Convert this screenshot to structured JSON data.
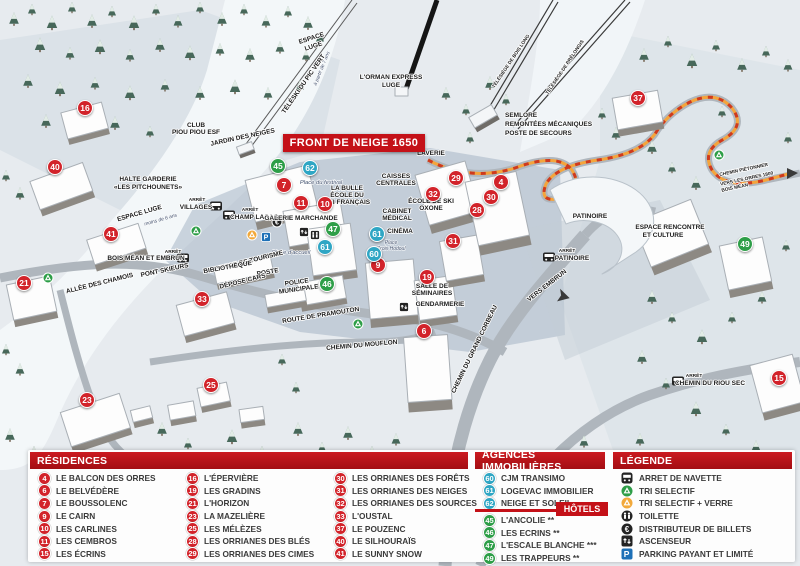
{
  "map": {
    "front_badge": "FRONT DE NEIGE 1650",
    "labels": [
      {
        "t": "ESPACE"
      },
      {
        "t": "LUGE"
      },
      {
        "t": "à partir de 7 ans"
      },
      {
        "t": "TÉLÉSKI DU PIC VERT"
      },
      {
        "t": "L'ORMAN EXPRESS"
      },
      {
        "t": "LUGE"
      },
      {
        "t": "TÉLÉSIÈGE DE BOIS LONG"
      },
      {
        "t": "TÉLÉSIÈGE DE PRÉLONGIS"
      },
      {
        "t": "SEMLORE"
      },
      {
        "t": "REMONTÉES MÉCANIQUES"
      },
      {
        "t": "POSTE DE SECOURS"
      },
      {
        "t": "LAVERIE"
      },
      {
        "t": "CLUB"
      },
      {
        "t": "PIOU PIOU ESF"
      },
      {
        "t": "JARDIN DES NEIGES"
      },
      {
        "t": "HALTE GARDERIE"
      },
      {
        "t": "«LES PITCHOUNETS»"
      },
      {
        "t": "ESPACE LUGE"
      },
      {
        "t": "moins de 6 ans"
      },
      {
        "t": "ARRÊT"
      },
      {
        "t": "VILLAGES"
      },
      {
        "t": "ARRÊT"
      },
      {
        "t": "CHAMP LACAS"
      },
      {
        "t": "GALERIE MARCHANDE"
      },
      {
        "t": "LA BULLE"
      },
      {
        "t": "ÉCOLE DU"
      },
      {
        "t": "SKI FRANÇAIS"
      },
      {
        "t": "Place du festival"
      },
      {
        "t": "CAISSES"
      },
      {
        "t": "CENTRALES"
      },
      {
        "t": "ÉCOLE DE SKI"
      },
      {
        "t": "OXONE"
      },
      {
        "t": "CABINET"
      },
      {
        "t": "MÉDICAL"
      },
      {
        "t": "CINÉMA"
      },
      {
        "t": "Place"
      },
      {
        "t": "Croix Hodoul"
      },
      {
        "t": "Place d'accueil"
      },
      {
        "t": "OFFICE DE TOURISME"
      },
      {
        "t": "BIBLIOTHÈQUE"
      },
      {
        "t": "POSTE"
      },
      {
        "t": "DÉPOSE CARS"
      },
      {
        "t": "POLICE"
      },
      {
        "t": "MUNICIPALE"
      },
      {
        "t": "ARRÊT"
      },
      {
        "t": "BOIS MÉAN ET EMBRUN"
      },
      {
        "t": "PONT SKIEURS"
      },
      {
        "t": "ALLÉE DES CHAMOIS"
      },
      {
        "t": "ROUTE DE PRAMOUTON"
      },
      {
        "t": "CHEMIN DU MOUFLON"
      },
      {
        "t": "CHEMIN DU GRAND CORBEAU"
      },
      {
        "t": "SALLE DE"
      },
      {
        "t": "SÉMINAIRES"
      },
      {
        "t": "GENDARMERIE"
      },
      {
        "t": "ARRÊT"
      },
      {
        "t": "PATINOIRE"
      },
      {
        "t": "PATINOIRE"
      },
      {
        "t": "ESPACE RENCONTRE"
      },
      {
        "t": "ET CULTURE"
      },
      {
        "t": "VERS EMBRUN"
      },
      {
        "t": "CHEMIN PIÉTONNIER"
      },
      {
        "t": "VERS LES ORRES 1800"
      },
      {
        "t": "BOIS MÉAN"
      },
      {
        "t": "ARRÊT"
      },
      {
        "t": "CHEMIN DU RIOU SEC"
      }
    ],
    "markers_red": [
      {
        "n": "16",
        "x": 85,
        "y": 108
      },
      {
        "n": "40",
        "x": 55,
        "y": 167
      },
      {
        "n": "41",
        "x": 111,
        "y": 234
      },
      {
        "n": "21",
        "x": 24,
        "y": 283
      },
      {
        "n": "33",
        "x": 202,
        "y": 299
      },
      {
        "n": "23",
        "x": 87,
        "y": 400
      },
      {
        "n": "25",
        "x": 211,
        "y": 385
      },
      {
        "n": "7",
        "x": 284,
        "y": 185
      },
      {
        "n": "11",
        "x": 301,
        "y": 203
      },
      {
        "n": "10",
        "x": 325,
        "y": 204
      },
      {
        "n": "9",
        "x": 378,
        "y": 265
      },
      {
        "n": "29",
        "x": 456,
        "y": 178
      },
      {
        "n": "32",
        "x": 433,
        "y": 194
      },
      {
        "n": "4",
        "x": 501,
        "y": 182
      },
      {
        "n": "30",
        "x": 491,
        "y": 197
      },
      {
        "n": "28",
        "x": 477,
        "y": 210
      },
      {
        "n": "31",
        "x": 453,
        "y": 241
      },
      {
        "n": "19",
        "x": 427,
        "y": 277
      },
      {
        "n": "6",
        "x": 424,
        "y": 331
      },
      {
        "n": "37",
        "x": 638,
        "y": 98
      },
      {
        "n": "15",
        "x": 779,
        "y": 378
      }
    ],
    "markers_green": [
      {
        "n": "45",
        "x": 278,
        "y": 166
      },
      {
        "n": "47",
        "x": 333,
        "y": 229
      },
      {
        "n": "46",
        "x": 327,
        "y": 284
      },
      {
        "n": "49",
        "x": 745,
        "y": 244
      }
    ],
    "markers_blue": [
      {
        "n": "62",
        "x": 310,
        "y": 168
      },
      {
        "n": "61",
        "x": 325,
        "y": 247
      },
      {
        "n": "61",
        "x": 377,
        "y": 234
      },
      {
        "n": "60",
        "x": 374,
        "y": 254
      }
    ]
  },
  "panel": {
    "residences": {
      "title": "RÉSIDENCES",
      "col1": [
        {
          "num": "4",
          "name": "LE BALCON DES ORRES"
        },
        {
          "num": "6",
          "name": "LE BELVÉDÈRE"
        },
        {
          "num": "7",
          "name": "LE BOUSSOLENC"
        },
        {
          "num": "9",
          "name": "LE CAIRN"
        },
        {
          "num": "10",
          "name": "LES CARLINES"
        },
        {
          "num": "11",
          "name": "LES CEMBROS"
        },
        {
          "num": "15",
          "name": "LES ÉCRINS"
        }
      ],
      "col2": [
        {
          "num": "16",
          "name": "L'ÉPERVIÈRE"
        },
        {
          "num": "19",
          "name": "LES GRADINS"
        },
        {
          "num": "21",
          "name": "L'HORIZON"
        },
        {
          "num": "23",
          "name": "LA MAZELIÈRE"
        },
        {
          "num": "25",
          "name": "LES MÉLÈZES"
        },
        {
          "num": "28",
          "name": "LES ORRIANES DES BLÉS"
        },
        {
          "num": "29",
          "name": "LES ORRIANES DES CIMES"
        }
      ],
      "col3": [
        {
          "num": "30",
          "name": "LES ORRIANES DES FORÊTS"
        },
        {
          "num": "31",
          "name": "LES ORRIANES DES NEIGES"
        },
        {
          "num": "32",
          "name": "LES ORRIANES DES SOURCES"
        },
        {
          "num": "33",
          "name": "L'OUSTAL"
        },
        {
          "num": "37",
          "name": "LE POUZENC"
        },
        {
          "num": "40",
          "name": "LE SILHOURAÏS"
        },
        {
          "num": "41",
          "name": "LE SUNNY SNOW"
        }
      ]
    },
    "agences": {
      "title": "AGENCES IMMOBILIÈRES",
      "items": [
        {
          "num": "60",
          "name": "CJM TRANSIMO"
        },
        {
          "num": "61",
          "name": "LOGEVAC IMMOBILIER"
        },
        {
          "num": "62",
          "name": "NEIGE ET SOLEIL"
        }
      ]
    },
    "hotels": {
      "title": "HÔTELS",
      "items": [
        {
          "num": "45",
          "name": "L'ANCOLIE **"
        },
        {
          "num": "46",
          "name": "LES ECRINS **"
        },
        {
          "num": "47",
          "name": "L'ESCALE BLANCHE ***"
        },
        {
          "num": "49",
          "name": "LES TRAPPEURS **"
        }
      ]
    },
    "legende": {
      "title": "LÉGENDE",
      "items": [
        {
          "icon": "bus-icon",
          "label": "ARRET DE NAVETTE"
        },
        {
          "icon": "recycle-green-icon",
          "label": "TRI SELECTIF"
        },
        {
          "icon": "recycle-glass-icon",
          "label": "TRI SELECTIF + VERRE"
        },
        {
          "icon": "toilet-icon",
          "label": "TOILETTE"
        },
        {
          "icon": "atm-euro-icon",
          "label": "DISTRIBUTEUR DE BILLETS"
        },
        {
          "icon": "elevator-icon",
          "label": "ASCENSEUR"
        },
        {
          "icon": "parking-icon",
          "label": "PARKING PAYANT ET LIMITÉ"
        }
      ]
    }
  },
  "colors": {
    "header_red": "#C41118",
    "marker_red": "#D2232A",
    "marker_green": "#2E9E48",
    "marker_blue": "#2FA6C4",
    "path_orange": "#F5A43B",
    "parking_blue": "#1D70B7",
    "glass_yellow": "#F2A93B"
  }
}
